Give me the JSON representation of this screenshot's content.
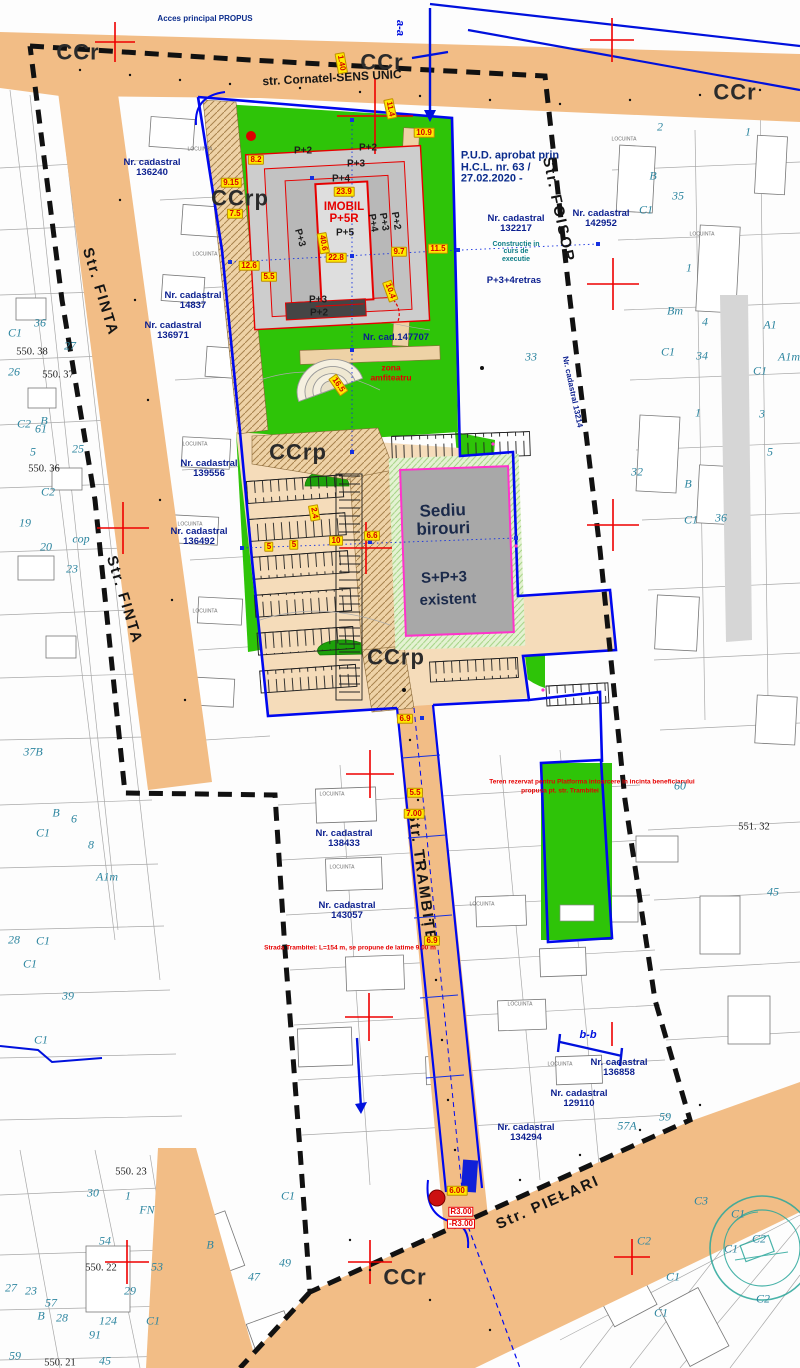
{
  "map_title": "Plan urbanistic de detaliu - plansa reglementari",
  "colors": {
    "street_fill": "#f2bd86",
    "green_zone": "#2ec408",
    "parking_fill": "#f5dcba",
    "path_hatch": "#eed2a6",
    "property_line_blue": "#0008ee",
    "study_limit_black": "#111111",
    "building_outline_red": "#e60000",
    "sediu_border_magenta": "#ff33cc",
    "dimension_bg_yellow": "#ffe900",
    "cadastral_text_navy": "#0b1f8f",
    "parcel_text_teal": "#2e86a0",
    "stamp_teal": "#2aa79b"
  },
  "labels": [
    {
      "t": "CCr",
      "x": 78,
      "y": 52,
      "c": "zone"
    },
    {
      "t": "CCr",
      "x": 382,
      "y": 62,
      "c": "zone"
    },
    {
      "t": "CCr",
      "x": 735,
      "y": 92,
      "c": "zone"
    },
    {
      "t": "CCrp",
      "x": 240,
      "y": 198,
      "c": "zone"
    },
    {
      "t": "CCrp",
      "x": 298,
      "y": 452,
      "c": "zone"
    },
    {
      "t": "CCrp",
      "x": 396,
      "y": 657,
      "c": "zone"
    },
    {
      "t": "CCr",
      "x": 405,
      "y": 1277,
      "c": "zone"
    },
    {
      "t": "str. Cornatel-SENS UNIC",
      "x": 332,
      "y": 78,
      "c": "street",
      "r": -3
    },
    {
      "t": "Str. FINTA",
      "x": 100,
      "y": 292,
      "c": "stlg",
      "r": 73
    },
    {
      "t": "Str. FINTA",
      "x": 124,
      "y": 600,
      "c": "stlg",
      "r": 73
    },
    {
      "t": "Str. FOISOR",
      "x": 558,
      "y": 210,
      "c": "stlg",
      "r": 78
    },
    {
      "t": "Str. TRAMBIȚEI",
      "x": 422,
      "y": 880,
      "c": "stlg",
      "r": 82
    },
    {
      "t": "Str. PIEŁARI",
      "x": 548,
      "y": 1203,
      "c": "stlg",
      "r": -24
    },
    {
      "t": "Acces principal PROPUS",
      "x": 205,
      "y": 19,
      "c": "navy"
    },
    {
      "t": "P.U.D. aprobat prin\nH.C.L. nr. 63 /\n27.02.2020 -",
      "x": 510,
      "y": 168,
      "c": "pud"
    },
    {
      "t": "Nr. cadastral\n136240",
      "x": 152,
      "y": 168,
      "c": "cad"
    },
    {
      "t": "Nr. cadastral\n14837",
      "x": 193,
      "y": 301,
      "c": "cad"
    },
    {
      "t": "Nr. cadastral\n136971",
      "x": 173,
      "y": 331,
      "c": "cad"
    },
    {
      "t": "Nr. cadastral\n132217",
      "x": 516,
      "y": 224,
      "c": "cad"
    },
    {
      "t": "Constructie in\ncurs de\nexecutie",
      "x": 516,
      "y": 252,
      "c": "teal"
    },
    {
      "t": "P+3+4retras",
      "x": 514,
      "y": 281,
      "c": "cad"
    },
    {
      "t": "Nr. cadastral\n142952",
      "x": 601,
      "y": 219,
      "c": "cad"
    },
    {
      "t": "Nr. cadastral\n139556",
      "x": 209,
      "y": 469,
      "c": "cad"
    },
    {
      "t": "Nr. cadastral\n136492",
      "x": 199,
      "y": 537,
      "c": "cad"
    },
    {
      "t": "Nr. cad.147707",
      "x": 396,
      "y": 338,
      "c": "cad"
    },
    {
      "t": "Nr. cadastral\n138433",
      "x": 344,
      "y": 839,
      "c": "cad"
    },
    {
      "t": "Nr. cadastral\n143057",
      "x": 347,
      "y": 911,
      "c": "cad"
    },
    {
      "t": "Nr. cadastral\n136858",
      "x": 619,
      "y": 1068,
      "c": "cad"
    },
    {
      "t": "Nr. cadastral\n129110",
      "x": 579,
      "y": 1099,
      "c": "cad"
    },
    {
      "t": "Nr. cadastral\n134294",
      "x": 526,
      "y": 1133,
      "c": "cad"
    },
    {
      "t": "Nr. cadastral 13214",
      "x": 572,
      "y": 392,
      "c": "cadv",
      "r": 78
    },
    {
      "t": "P+2",
      "x": 303,
      "y": 152,
      "c": "bld"
    },
    {
      "t": "P+2",
      "x": 368,
      "y": 149,
      "c": "bld"
    },
    {
      "t": "P+3",
      "x": 356,
      "y": 165,
      "c": "bld"
    },
    {
      "t": "P+4",
      "x": 341,
      "y": 180,
      "c": "bld"
    },
    {
      "t": "P+5",
      "x": 345,
      "y": 234,
      "c": "bld"
    },
    {
      "t": "P+3",
      "x": 299,
      "y": 238,
      "c": "bld",
      "r": 75
    },
    {
      "t": "P+4",
      "x": 372,
      "y": 223,
      "c": "bld",
      "r": 80
    },
    {
      "t": "P+3",
      "x": 383,
      "y": 222,
      "c": "bld",
      "r": 80
    },
    {
      "t": "P+2",
      "x": 395,
      "y": 221,
      "c": "bld",
      "r": 80
    },
    {
      "t": "P+3",
      "x": 318,
      "y": 301,
      "c": "bld"
    },
    {
      "t": "P+2",
      "x": 319,
      "y": 314,
      "c": "bld"
    },
    {
      "t": "IMOBIL",
      "x": 344,
      "y": 207,
      "c": "redb"
    },
    {
      "t": "P+5R",
      "x": 344,
      "y": 219,
      "c": "redb"
    },
    {
      "t": "zona",
      "x": 391,
      "y": 368,
      "c": "redn"
    },
    {
      "t": "amfiteatru",
      "x": 391,
      "y": 378,
      "c": "redn"
    },
    {
      "t": "Strada Trambitei: L=154 m, se propune de latime 9.00 m",
      "x": 350,
      "y": 949,
      "c": "redt"
    },
    {
      "t": "Teren rezervat pentru Platforma intoarcere in incinta beneficiarului",
      "x": 592,
      "y": 783,
      "c": "redt"
    },
    {
      "t": "propusa pt. str. Trambitei",
      "x": 560,
      "y": 792,
      "c": "redt"
    },
    {
      "t": "R3.00",
      "x": 461,
      "y": 1212,
      "c": "rbox"
    },
    {
      "t": "-R3.00",
      "x": 461,
      "y": 1224,
      "c": "rbox"
    },
    {
      "t": "Sediu\nbirouri",
      "x": 443,
      "y": 520,
      "c": "sed1",
      "r": -2
    },
    {
      "t": "S+P+3",
      "x": 444,
      "y": 578,
      "c": "sed2",
      "r": -2
    },
    {
      "t": "existent",
      "x": 448,
      "y": 600,
      "c": "sed2",
      "r": -2
    },
    {
      "t": "a-a",
      "x": 399,
      "y": 28,
      "c": "bsec",
      "r": 90
    },
    {
      "t": "b-b",
      "x": 588,
      "y": 1036,
      "c": "bsec"
    },
    {
      "t": "8.2",
      "x": 256,
      "y": 160,
      "c": "dim"
    },
    {
      "t": "9.15",
      "x": 231,
      "y": 183,
      "c": "dim"
    },
    {
      "t": "7.5",
      "x": 235,
      "y": 214,
      "c": "dim"
    },
    {
      "t": "12.6",
      "x": 249,
      "y": 266,
      "c": "dim"
    },
    {
      "t": "5.5",
      "x": 269,
      "y": 277,
      "c": "dim"
    },
    {
      "t": "23.9",
      "x": 344,
      "y": 192,
      "c": "dim"
    },
    {
      "t": "40.6",
      "x": 323,
      "y": 243,
      "c": "dim",
      "r": 80
    },
    {
      "t": "22.8",
      "x": 336,
      "y": 258,
      "c": "dim"
    },
    {
      "t": "10.9",
      "x": 424,
      "y": 133,
      "c": "dim"
    },
    {
      "t": "11.5",
      "x": 438,
      "y": 249,
      "c": "dim"
    },
    {
      "t": "9.7",
      "x": 399,
      "y": 252,
      "c": "dim"
    },
    {
      "t": "10.4",
      "x": 390,
      "y": 291,
      "c": "dim",
      "r": 70
    },
    {
      "t": "16.5",
      "x": 338,
      "y": 385,
      "c": "dim",
      "r": 55
    },
    {
      "t": "6.6",
      "x": 372,
      "y": 536,
      "c": "dim"
    },
    {
      "t": "5",
      "x": 269,
      "y": 547,
      "c": "dim"
    },
    {
      "t": "5",
      "x": 294,
      "y": 545,
      "c": "dim"
    },
    {
      "t": "10",
      "x": 336,
      "y": 541,
      "c": "dim"
    },
    {
      "t": "2.4",
      "x": 314,
      "y": 513,
      "c": "dim",
      "r": 80
    },
    {
      "t": "6.9",
      "x": 405,
      "y": 719,
      "c": "dim"
    },
    {
      "t": "5.5",
      "x": 415,
      "y": 793,
      "c": "dim"
    },
    {
      "t": "7.00",
      "x": 414,
      "y": 814,
      "c": "dim"
    },
    {
      "t": "6.9",
      "x": 432,
      "y": 941,
      "c": "dim"
    },
    {
      "t": "6.00",
      "x": 457,
      "y": 1191,
      "c": "dim"
    },
    {
      "t": "1.40",
      "x": 341,
      "y": 63,
      "c": "dim",
      "r": 80
    },
    {
      "t": "11.4",
      "x": 390,
      "y": 109,
      "c": "dim",
      "r": 78
    },
    {
      "t": "36",
      "x": 40,
      "y": 323,
      "c": "plot"
    },
    {
      "t": "27",
      "x": 70,
      "y": 346,
      "c": "plot"
    },
    {
      "t": "C1",
      "x": 15,
      "y": 333,
      "c": "plot"
    },
    {
      "t": "26",
      "x": 14,
      "y": 372,
      "c": "plot"
    },
    {
      "t": "C2",
      "x": 24,
      "y": 424,
      "c": "plot"
    },
    {
      "t": "B",
      "x": 44,
      "y": 421,
      "c": "plot"
    },
    {
      "t": "61",
      "x": 41,
      "y": 429,
      "c": "plot"
    },
    {
      "t": "5",
      "x": 33,
      "y": 452,
      "c": "plot"
    },
    {
      "t": "25",
      "x": 78,
      "y": 449,
      "c": "plot"
    },
    {
      "t": "19",
      "x": 25,
      "y": 523,
      "c": "plot"
    },
    {
      "t": "20",
      "x": 46,
      "y": 547,
      "c": "plot"
    },
    {
      "t": "C2",
      "x": 48,
      "y": 492,
      "c": "plot"
    },
    {
      "t": "cop",
      "x": 81,
      "y": 539,
      "c": "plot"
    },
    {
      "t": "23",
      "x": 72,
      "y": 569,
      "c": "plot"
    },
    {
      "t": "37B",
      "x": 33,
      "y": 752,
      "c": "plot"
    },
    {
      "t": "B",
      "x": 56,
      "y": 813,
      "c": "plot"
    },
    {
      "t": "6",
      "x": 74,
      "y": 819,
      "c": "plot"
    },
    {
      "t": "8",
      "x": 91,
      "y": 845,
      "c": "plot"
    },
    {
      "t": "A1m",
      "x": 107,
      "y": 877,
      "c": "plot"
    },
    {
      "t": "C1",
      "x": 43,
      "y": 833,
      "c": "plot"
    },
    {
      "t": "28",
      "x": 14,
      "y": 940,
      "c": "plot"
    },
    {
      "t": "C1",
      "x": 43,
      "y": 941,
      "c": "plot"
    },
    {
      "t": "C1",
      "x": 30,
      "y": 964,
      "c": "plot"
    },
    {
      "t": "39",
      "x": 68,
      "y": 996,
      "c": "plot"
    },
    {
      "t": "C1",
      "x": 41,
      "y": 1040,
      "c": "plot"
    },
    {
      "t": "2",
      "x": 660,
      "y": 127,
      "c": "plot"
    },
    {
      "t": "1",
      "x": 748,
      "y": 132,
      "c": "plot"
    },
    {
      "t": "35",
      "x": 678,
      "y": 196,
      "c": "plot"
    },
    {
      "t": "B",
      "x": 653,
      "y": 176,
      "c": "plot"
    },
    {
      "t": "C1",
      "x": 646,
      "y": 210,
      "c": "plot"
    },
    {
      "t": "Bm",
      "x": 675,
      "y": 311,
      "c": "plot"
    },
    {
      "t": "1",
      "x": 689,
      "y": 268,
      "c": "plot"
    },
    {
      "t": "4",
      "x": 705,
      "y": 322,
      "c": "plot"
    },
    {
      "t": "A1",
      "x": 770,
      "y": 325,
      "c": "plot"
    },
    {
      "t": "C1",
      "x": 668,
      "y": 352,
      "c": "plot"
    },
    {
      "t": "34",
      "x": 702,
      "y": 356,
      "c": "plot"
    },
    {
      "t": "A1m",
      "x": 789,
      "y": 357,
      "c": "plot"
    },
    {
      "t": "C1",
      "x": 760,
      "y": 371,
      "c": "plot"
    },
    {
      "t": "1",
      "x": 698,
      "y": 413,
      "c": "plot"
    },
    {
      "t": "3",
      "x": 762,
      "y": 414,
      "c": "plot"
    },
    {
      "t": "5",
      "x": 770,
      "y": 452,
      "c": "plot"
    },
    {
      "t": "32",
      "x": 637,
      "y": 472,
      "c": "plot"
    },
    {
      "t": "33",
      "x": 531,
      "y": 357,
      "c": "plot"
    },
    {
      "t": "B",
      "x": 688,
      "y": 484,
      "c": "plot"
    },
    {
      "t": "C1",
      "x": 691,
      "y": 520,
      "c": "plot"
    },
    {
      "t": "36",
      "x": 721,
      "y": 518,
      "c": "plot"
    },
    {
      "t": "60",
      "x": 680,
      "y": 786,
      "c": "plot"
    },
    {
      "t": "45",
      "x": 773,
      "y": 892,
      "c": "plot"
    },
    {
      "t": "57A",
      "x": 627,
      "y": 1126,
      "c": "plot"
    },
    {
      "t": "59",
      "x": 665,
      "y": 1117,
      "c": "plot"
    },
    {
      "t": "30",
      "x": 93,
      "y": 1193,
      "c": "plot"
    },
    {
      "t": "1",
      "x": 128,
      "y": 1196,
      "c": "plot"
    },
    {
      "t": "FN",
      "x": 147,
      "y": 1210,
      "c": "plot"
    },
    {
      "t": "54",
      "x": 105,
      "y": 1241,
      "c": "plot"
    },
    {
      "t": "53",
      "x": 157,
      "y": 1267,
      "c": "plot"
    },
    {
      "t": "29",
      "x": 130,
      "y": 1291,
      "c": "plot"
    },
    {
      "t": "27",
      "x": 11,
      "y": 1288,
      "c": "plot"
    },
    {
      "t": "23",
      "x": 31,
      "y": 1291,
      "c": "plot"
    },
    {
      "t": "57",
      "x": 51,
      "y": 1303,
      "c": "plot"
    },
    {
      "t": "B",
      "x": 41,
      "y": 1316,
      "c": "plot"
    },
    {
      "t": "28",
      "x": 62,
      "y": 1318,
      "c": "plot"
    },
    {
      "t": "124",
      "x": 108,
      "y": 1321,
      "c": "plot"
    },
    {
      "t": "91",
      "x": 95,
      "y": 1335,
      "c": "plot"
    },
    {
      "t": "C1",
      "x": 153,
      "y": 1321,
      "c": "plot"
    },
    {
      "t": "45",
      "x": 105,
      "y": 1361,
      "c": "plot"
    },
    {
      "t": "59",
      "x": 15,
      "y": 1356,
      "c": "plot"
    },
    {
      "t": "B",
      "x": 210,
      "y": 1245,
      "c": "plot"
    },
    {
      "t": "47",
      "x": 254,
      "y": 1277,
      "c": "plot"
    },
    {
      "t": "49",
      "x": 285,
      "y": 1263,
      "c": "plot"
    },
    {
      "t": "C1",
      "x": 288,
      "y": 1196,
      "c": "plot"
    },
    {
      "t": "C3",
      "x": 701,
      "y": 1201,
      "c": "plot"
    },
    {
      "t": "C1",
      "x": 738,
      "y": 1214,
      "c": "plot"
    },
    {
      "t": "C2",
      "x": 759,
      "y": 1239,
      "c": "plot"
    },
    {
      "t": "C1",
      "x": 731,
      "y": 1249,
      "c": "plot"
    },
    {
      "t": "C2",
      "x": 763,
      "y": 1299,
      "c": "plot"
    },
    {
      "t": "C1",
      "x": 673,
      "y": 1277,
      "c": "plot"
    },
    {
      "t": "C1",
      "x": 661,
      "y": 1313,
      "c": "plot"
    },
    {
      "t": "C2",
      "x": 644,
      "y": 1241,
      "c": "plot"
    },
    {
      "t": "550. 38",
      "x": 32,
      "y": 352,
      "c": "surv"
    },
    {
      "t": "550. 37",
      "x": 58,
      "y": 375,
      "c": "surv"
    },
    {
      "t": "550. 36",
      "x": 44,
      "y": 469,
      "c": "surv"
    },
    {
      "t": "551. 32",
      "x": 754,
      "y": 827,
      "c": "surv"
    },
    {
      "t": "550. 23",
      "x": 131,
      "y": 1172,
      "c": "surv"
    },
    {
      "t": "550. 22",
      "x": 101,
      "y": 1268,
      "c": "surv"
    },
    {
      "t": "550. 21",
      "x": 60,
      "y": 1363,
      "c": "surv"
    },
    {
      "t": "LOCUINTA",
      "x": 200,
      "y": 150,
      "c": "tb"
    },
    {
      "t": "LOCUINTA",
      "x": 205,
      "y": 255,
      "c": "tb"
    },
    {
      "t": "LOCUINTA",
      "x": 195,
      "y": 445,
      "c": "tb"
    },
    {
      "t": "LOCUINTA",
      "x": 190,
      "y": 525,
      "c": "tb"
    },
    {
      "t": "LOCUINTA",
      "x": 205,
      "y": 612,
      "c": "tb"
    },
    {
      "t": "LOCUINTA",
      "x": 332,
      "y": 795,
      "c": "tb"
    },
    {
      "t": "LOCUINTA",
      "x": 342,
      "y": 868,
      "c": "tb"
    },
    {
      "t": "LOCUINTA",
      "x": 482,
      "y": 905,
      "c": "tb"
    },
    {
      "t": "LOCUINTA",
      "x": 520,
      "y": 1005,
      "c": "tb"
    },
    {
      "t": "LOCUINTA",
      "x": 560,
      "y": 1065,
      "c": "tb"
    },
    {
      "t": "LOCUINTA",
      "x": 624,
      "y": 140,
      "c": "tb"
    },
    {
      "t": "LOCUINTA",
      "x": 702,
      "y": 235,
      "c": "tb"
    }
  ]
}
